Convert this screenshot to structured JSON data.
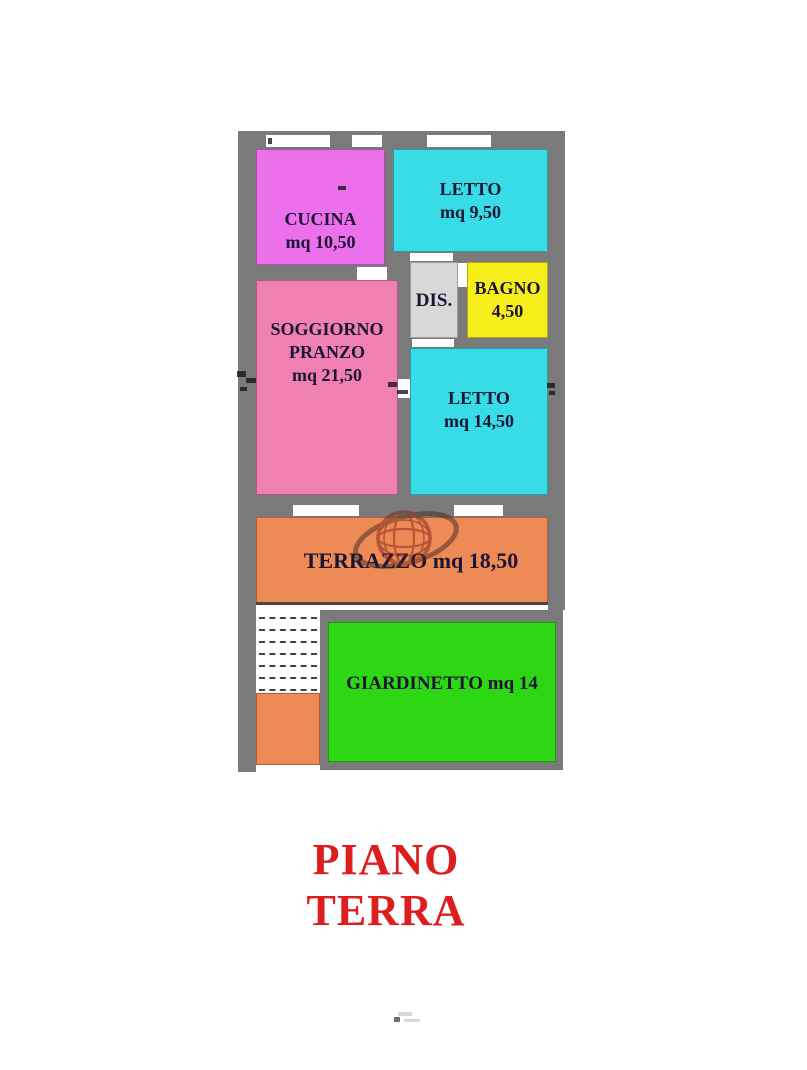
{
  "plan": {
    "rooms": {
      "cucina": {
        "name": "CUCINA",
        "area": "mq 10,50",
        "color": "#ec70ec"
      },
      "letto1": {
        "name": "LETTO",
        "area": "mq 9,50",
        "color": "#38dce6"
      },
      "dis": {
        "name": "DIS.",
        "color": "#d8d8d8"
      },
      "bagno": {
        "name": "BAGNO",
        "area": "4,50",
        "color": "#f6ee1a"
      },
      "soggiorno": {
        "name": "SOGGIORNO",
        "name2": "PRANZO",
        "area": "mq 21,50",
        "color": "#f07fb2"
      },
      "letto2": {
        "name": "LETTO",
        "area": "mq 14,50",
        "color": "#38dce6"
      },
      "terrazzo": {
        "label": "TERRAZZO mq 18,50",
        "color": "#ee8a55"
      },
      "giardinetto": {
        "label": "GIARDINETTO mq 14",
        "color": "#2ed714"
      },
      "balcone_color": "#ee8a55",
      "scala_color": "#ffffff"
    },
    "wall_color": "#7a7a7a",
    "label_color": "#1b1535"
  },
  "title": {
    "text": "PIANO TERRA",
    "color": "#dc1e1e"
  },
  "watermark": {
    "icon": "globe-icon",
    "color": "#7a2416"
  }
}
